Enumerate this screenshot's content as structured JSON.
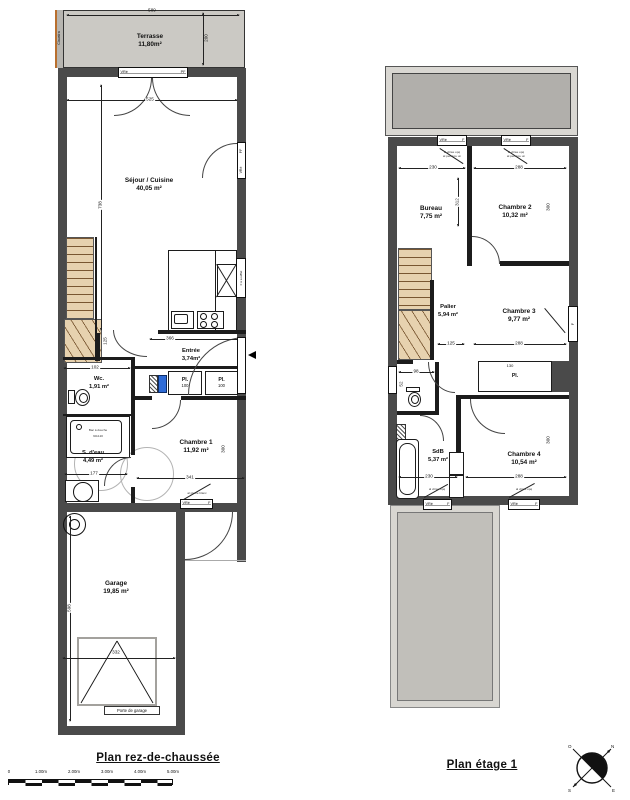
{
  "ground": {
    "title": "Plan rez-de-chaussée",
    "claustra": "Claustra",
    "terrasse": {
      "name": "Terrasse",
      "area": "11,80m²"
    },
    "sejour": {
      "name": "Séjour / Cuisine",
      "area": "40,05 m²"
    },
    "entree": {
      "name": "Entrée",
      "area": "3,74m²"
    },
    "wc": {
      "name": "Wc.",
      "area": "1,91 m²"
    },
    "sdeau": {
      "name": "S. d'eau",
      "area": "4,49 m²"
    },
    "chambre1": {
      "name": "Chambre 1",
      "area": "11,92 m²"
    },
    "garage": {
      "name": "Garage",
      "area": "19,85 m²"
    },
    "pl1": {
      "label": "Pl.",
      "size": "100"
    },
    "pl2": {
      "label": "Pl.",
      "size": "100"
    },
    "shower": {
      "line1": "Bac à douche",
      "line2": "90x120"
    },
    "garage_door": "Porte de garage",
    "win_top": {
      "left": "VRé",
      "right": "PF"
    },
    "win_bay": {
      "top": "PF",
      "bottom": "VRé"
    },
    "win_kitchen": "F à soufflet",
    "win_ch1": {
      "left": "VRé",
      "right": "F",
      "note": "al pleine blanc"
    },
    "dims": {
      "terrasse_w": "589",
      "terrasse_h": "200",
      "sejour_w": "525",
      "interior_h": "738",
      "stairs_w": "102",
      "stairs_h": "125",
      "entree_w": "366",
      "sdeau_w": "177",
      "ch1_w": "341",
      "ch1_h": "300",
      "garage_h": "598",
      "garage_door_w": "332"
    }
  },
  "etage": {
    "title": "Plan étage 1",
    "bureau": {
      "name": "Bureau",
      "area": "7,75 m²"
    },
    "chambre2": {
      "name": "Chambre 2",
      "area": "10,32 m²"
    },
    "palier": {
      "name": "Palier",
      "area": "5,94 m²"
    },
    "chambre3": {
      "name": "Chambre 3",
      "area": "9,77 m²"
    },
    "sdb": {
      "name": "SdB",
      "area": "5,37 m²"
    },
    "chambre4": {
      "name": "Chambre 4",
      "area": "10,54 m²"
    },
    "pl": {
      "label": "Pl.",
      "size": "130"
    },
    "win": {
      "vr": "VRé",
      "f": "F",
      "note1": "al vitrée opq",
      "note2": "al peinture un"
    },
    "dims": {
      "bureau_w": "230",
      "chambre2_w": "288",
      "mid_h": "312",
      "right_h_top": "300",
      "palier_w": "125",
      "chambre3_w": "288",
      "wc_w": "98",
      "wc_h": "52",
      "sdb_w": "230",
      "chambre4_w": "288",
      "right_h_bottom": "300"
    }
  },
  "footer": {
    "scale": [
      "0",
      "1.00m",
      "2.00m",
      "3.00m",
      "4.00m",
      "5.00m"
    ],
    "compass": [
      "N",
      "E",
      "S",
      "O"
    ]
  }
}
